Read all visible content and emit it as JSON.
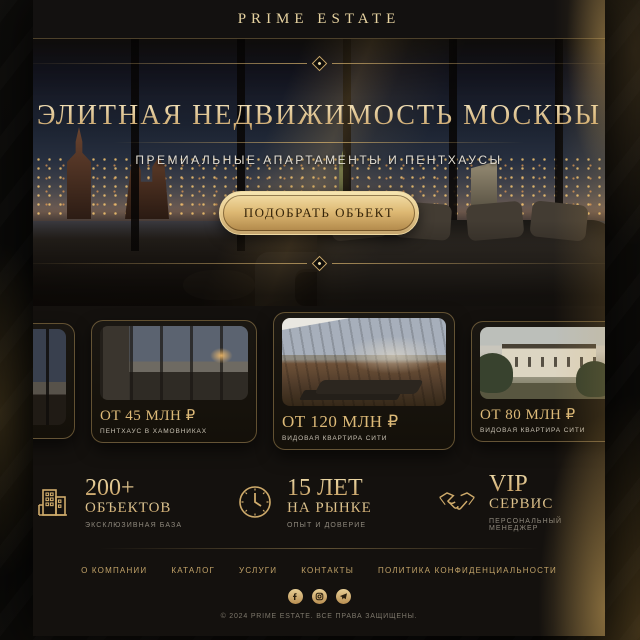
{
  "brand": {
    "name": "PRIME ESTATE"
  },
  "hero": {
    "title": "ЭЛИТНАЯ НЕДВИЖИМОСТЬ МОСКВЫ",
    "subtitle": "ПРЕМИАЛЬНЫЕ АПАРТАМЕНТЫ И ПЕНТХАУСЫ",
    "cta_label": "ПОДОБРАТЬ ОБЪЕКТ"
  },
  "listings": [
    {
      "image": "night-interior"
    },
    {
      "price": "ОТ 45 МЛН ₽",
      "label": "ПЕНТХАУС В ХАМОВНИКАХ",
      "image": "penthouse-interior"
    },
    {
      "price": "ОТ 120 МЛН ₽",
      "label": "ВИДОВАЯ КВАРТИРА СИТИ",
      "image": "terrace-view"
    },
    {
      "price": "ОТ 80 МЛН ₽",
      "label": "ВИДОВАЯ КВАРТИРА СИТИ",
      "image": "classic-mansion"
    },
    {
      "price": "ОТ 8",
      "label": "ПЕНТХАУ",
      "image": "evening-building"
    }
  ],
  "stats": [
    {
      "icon": "building-icon",
      "value": "200+",
      "title": "ОБЪЕКТОВ",
      "caption": "ЭКСКЛЮЗИВНАЯ БАЗА"
    },
    {
      "icon": "clock-icon",
      "value": "15 ЛЕТ",
      "title": "НА РЫНКЕ",
      "caption": "ОПЫТ И ДОВЕРИЕ"
    },
    {
      "icon": "handshake-icon",
      "value": "VIP",
      "title": "СЕРВИС",
      "caption": "ПЕРСОНАЛЬНЫЙ МЕНЕДЖЕР"
    }
  ],
  "footer": {
    "links": [
      {
        "label": "О КОМПАНИИ"
      },
      {
        "label": "КАТАЛОГ"
      },
      {
        "label": "УСЛУГИ"
      },
      {
        "label": "КОНТАКТЫ"
      },
      {
        "label": "ПОЛИТИКА КОНФИДЕНЦИАЛЬНОСТИ"
      }
    ],
    "social": [
      "facebook-icon",
      "instagram-icon",
      "telegram-icon"
    ],
    "copyright": "© 2024 PRIME ESTATE. ВСЕ ПРАВА ЗАЩИЩЕНЫ."
  },
  "colors": {
    "gold": "#cfab6b",
    "gold_light": "#f1dfae",
    "page_background": "#14110e",
    "outer_background": "#070605",
    "text_light": "#e2ddd2",
    "text_muted": "#8f897d"
  }
}
